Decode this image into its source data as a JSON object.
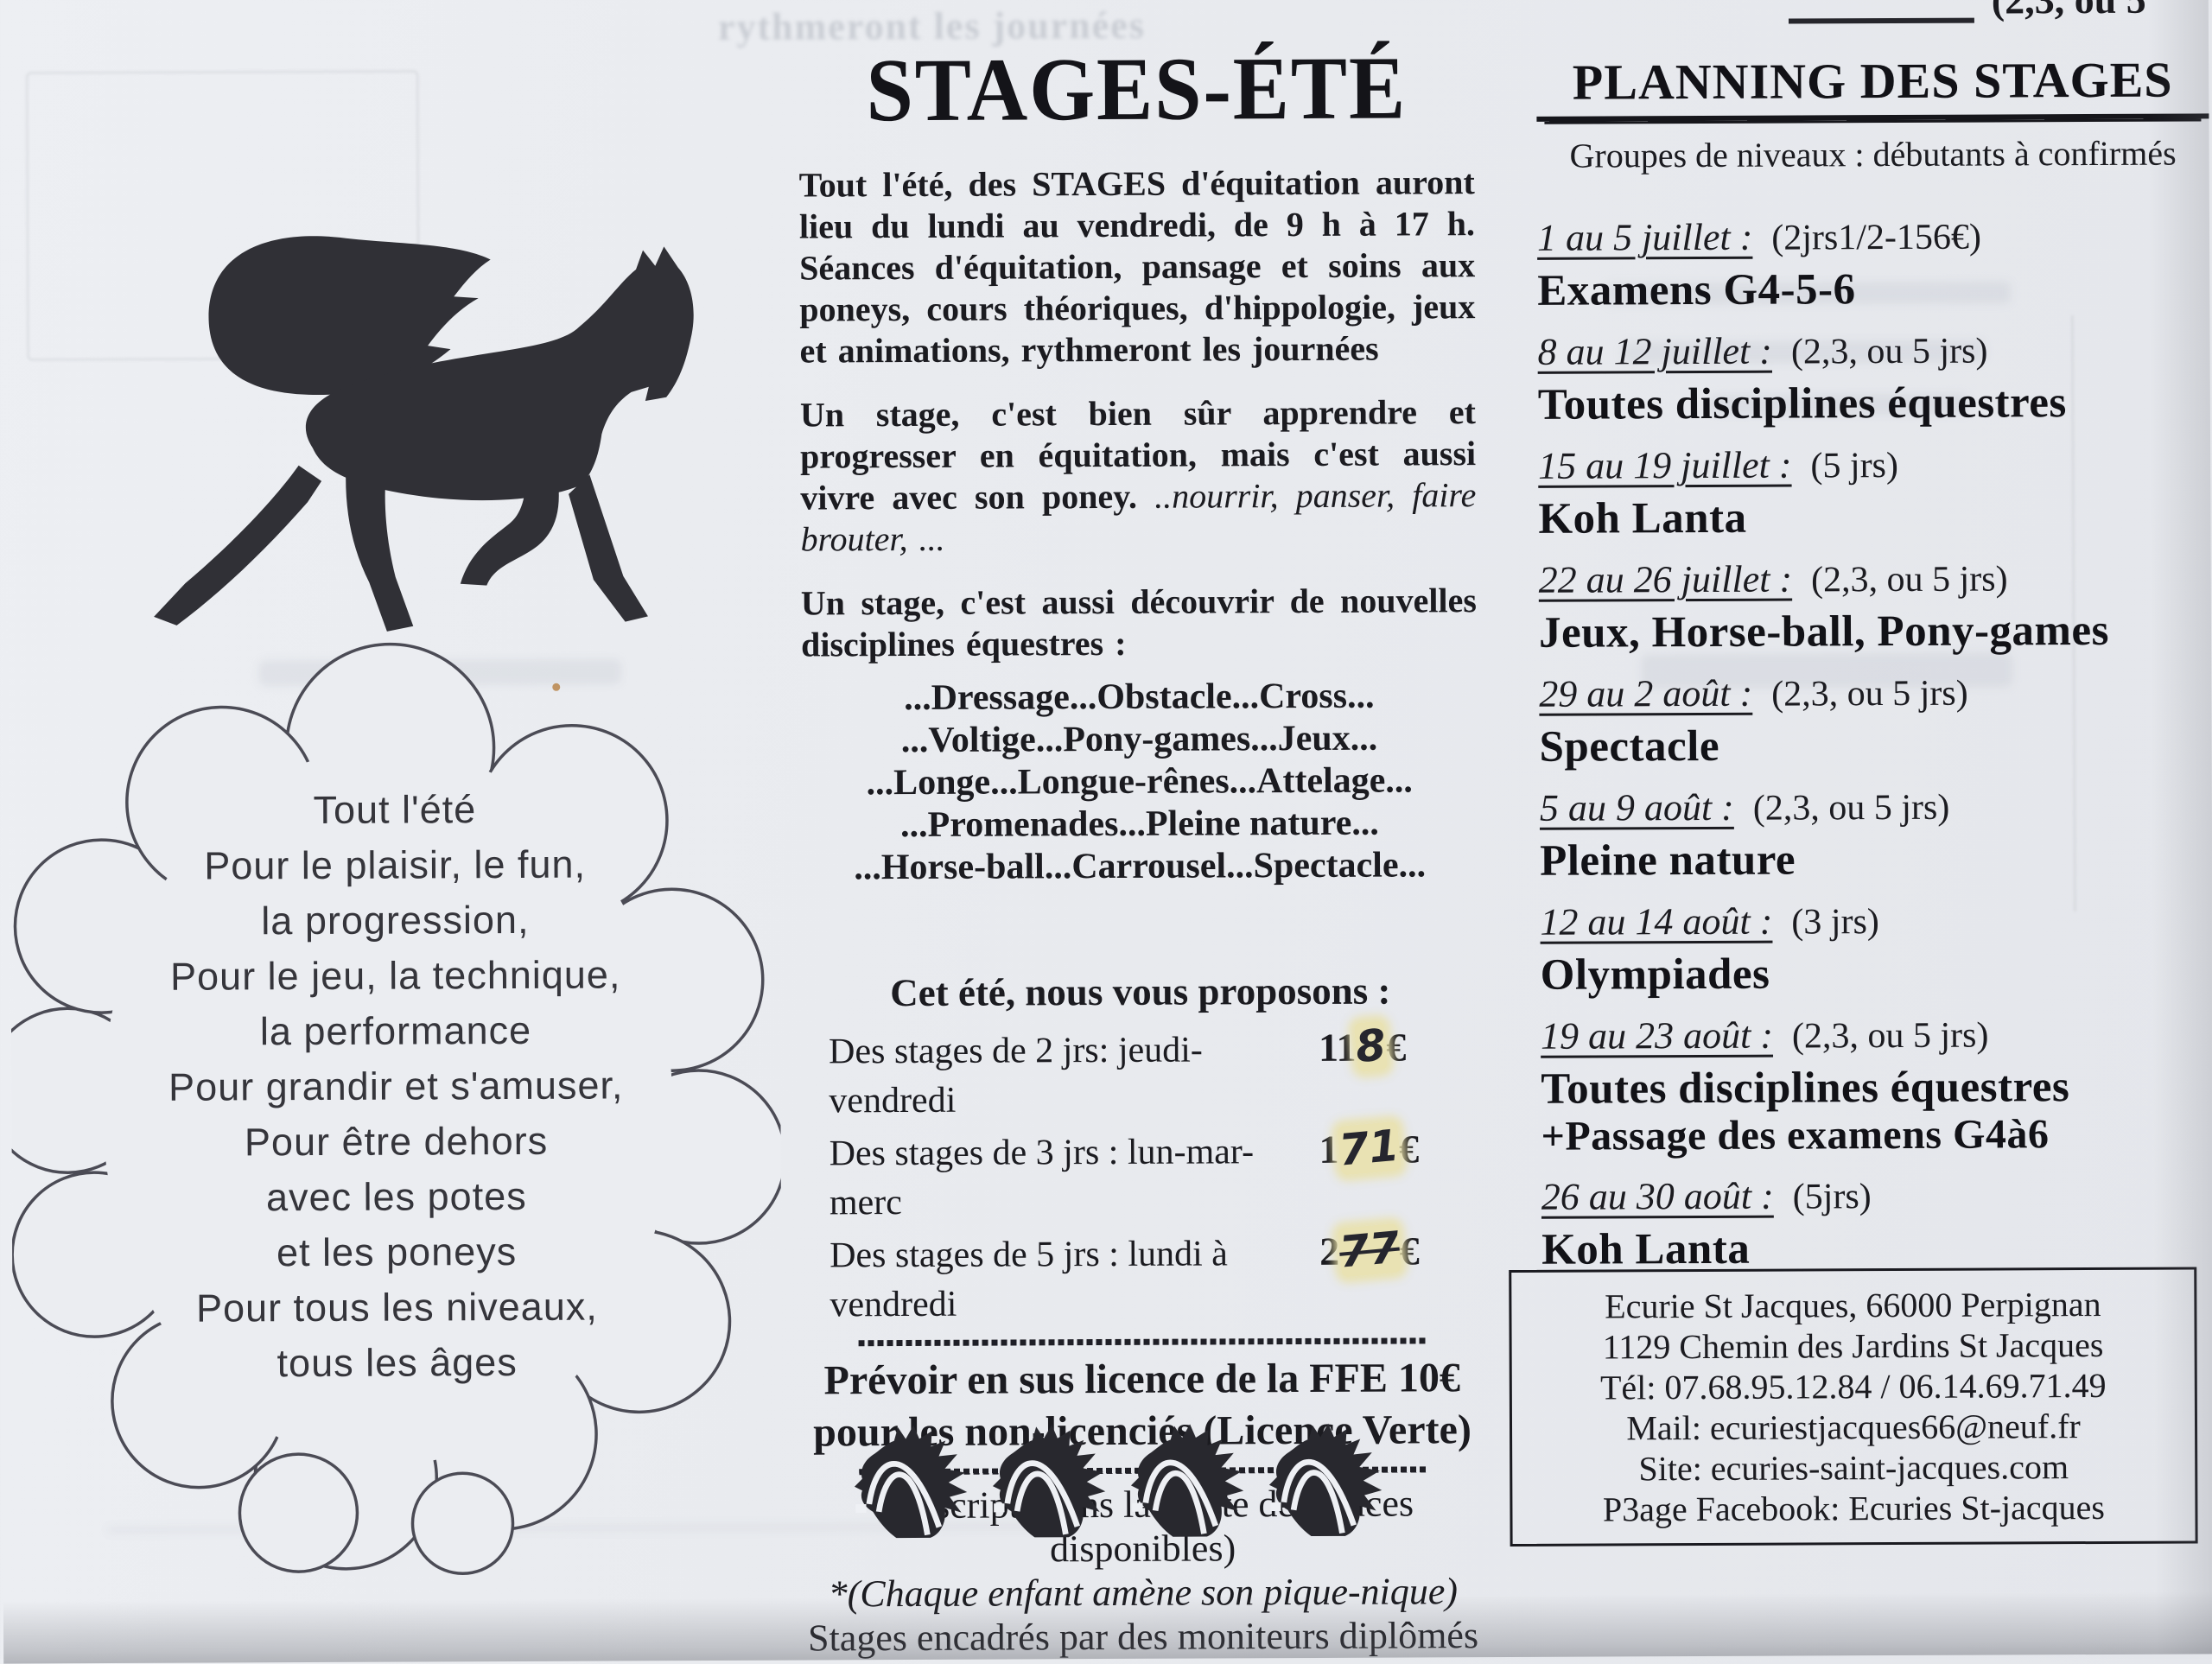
{
  "page": {
    "top_fragment": "(2,3, ou 5",
    "ghost_line": "rythmeront les journées"
  },
  "colors": {
    "paper": "#e9ebef",
    "ink": "#1b1b20",
    "highlight": "#e9e1a8"
  },
  "cloud": {
    "lines": [
      "Tout l'été",
      "Pour le plaisir, le fun,",
      "la progression,",
      "Pour le jeu, la technique,",
      "la performance",
      "Pour grandir et s'amuser,",
      "Pour être dehors",
      "avec les potes",
      "et les poneys",
      "Pour tous les niveaux,",
      "tous les âges"
    ]
  },
  "intro": {
    "title": "STAGES-ÉTÉ",
    "p1": "Tout l'été, des STAGES d'équitation auront lieu du lundi au vendredi, de 9 h à 17 h. Séances d'équitation, pansage et soins aux poneys, cours théoriques, d'hippologie, jeux et animations, rythmeront les journées",
    "p2_text": "Un stage, c'est bien sûr apprendre et progresser en équitation, mais c'est aussi vivre avec son poney. ",
    "p2_italic": "..nourrir, panser, faire brouter, ...",
    "p3": "Un stage, c'est aussi découvrir de nouvelles disciplines équestres :",
    "disciplines": [
      "...Dressage...Obstacle...Cross...",
      "...Voltige...Pony-games...Jeux...",
      "...Longe...Longue-rênes...Attelage...",
      "...Promenades...Pleine nature...",
      "...Horse-ball...Carrousel...Spectacle..."
    ]
  },
  "offers": {
    "heading": "Cet été, nous vous proposons :",
    "rows": [
      {
        "label": "Des stages de 2 jrs: jeudi-vendredi",
        "printed": "11",
        "hand": "8",
        "currency": "€"
      },
      {
        "label": "Des stages de 3 jrs : lun-mar-merc",
        "printed": "1",
        "hand": "71",
        "currency": "€"
      },
      {
        "label": "Des stages de 5 jrs : lundi à vendredi",
        "printed": "2",
        "hand": "77",
        "currency": "€"
      }
    ],
    "licence_line1": "Prévoir en sus licence de la FFE 10€",
    "licence_line2": "pour les non-licenciés (Licence Verte)",
    "note1": "*(Inscript° dans la limite des places disponibles)",
    "note2": "*(Chaque enfant amène son pique-nique)",
    "note3": "Stages encadrés par des moniteurs diplômés"
  },
  "planning": {
    "title": "PLANNING DES STAGES",
    "subtitle": "Groupes de niveaux : débutants à confirmés",
    "entries": [
      {
        "date": "1 au 5 juillet :",
        "info": "(2jrs1/2-156€)",
        "activity": "Examens G4-5-6"
      },
      {
        "date": "8 au 12 juillet :",
        "info": "(2,3, ou 5 jrs)",
        "activity": "Toutes disciplines équestres"
      },
      {
        "date": "15 au 19 juillet :",
        "info": "(5 jrs)",
        "activity": "Koh Lanta"
      },
      {
        "date": "22 au 26 juillet :",
        "info": "(2,3, ou 5 jrs)",
        "activity": "Jeux, Horse-ball, Pony-games"
      },
      {
        "date": "29 au 2 août :",
        "info": "(2,3, ou 5 jrs)",
        "activity": "Spectacle"
      },
      {
        "date": "5 au 9 août :",
        "info": "(2,3, ou 5 jrs)",
        "activity": "Pleine nature"
      },
      {
        "date": "12 au 14 août :",
        "info": "(3 jrs)",
        "activity": "Olympiades"
      },
      {
        "date": "19 au 23 août :",
        "info": "(2,3, ou 5 jrs)",
        "activity": "Toutes disciplines équestres",
        "activity2": "+Passage des examens G4à6"
      },
      {
        "date": "26 au 30 août :",
        "info": "(5jrs)",
        "activity": "Koh Lanta"
      }
    ]
  },
  "contact": {
    "lines": [
      "Ecurie St Jacques, 66000 Perpignan",
      "1129 Chemin des Jardins St Jacques",
      "Tél: 07.68.95.12.84 / 06.14.69.71.49",
      "Mail: ecuriestjacques66@neuf.fr",
      "Site: ecuries-saint-jacques.com",
      "P3age Facebook: Ecuries St-jacques"
    ]
  }
}
